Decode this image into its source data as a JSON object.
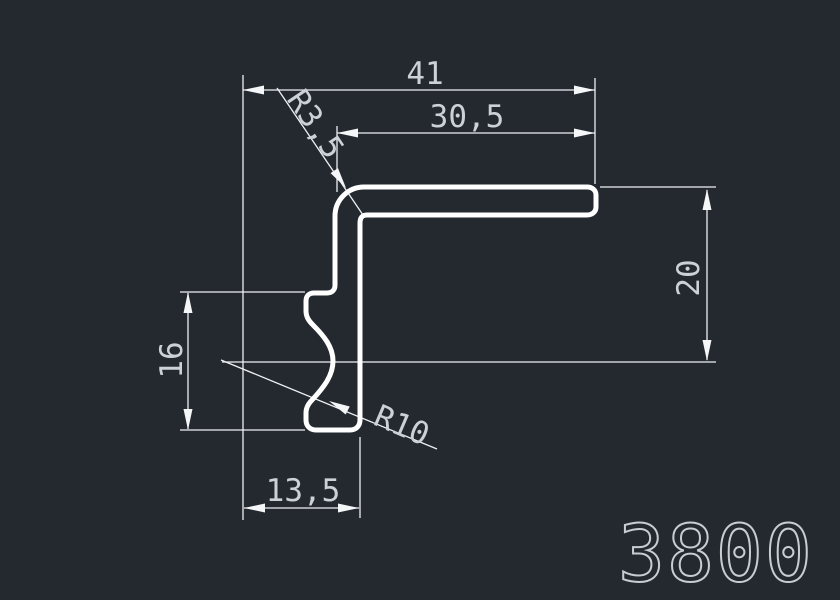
{
  "app": {
    "type": "cad-profile-drawing-viewer",
    "background_color": "#23292f",
    "profile_line_color": "#ffffff",
    "dimension_line_color": "#eef1f3",
    "dimension_text_color": "#ccd1d5",
    "part_number_color": "#c8cdd1"
  },
  "drawing": {
    "part_number": "3800",
    "description": "L-shaped aluminium profile cross-section with dimensions",
    "dimensions": {
      "overall_width": {
        "label": "41",
        "value": 41
      },
      "top_width": {
        "label": "30,5",
        "value": 30.5
      },
      "corner_radius": {
        "label": "R3,5",
        "value": 3.5
      },
      "right_height": {
        "label": "20",
        "value": 20
      },
      "left_height": {
        "label": "16",
        "value": 16
      },
      "bottom_width": {
        "label": "13,5",
        "value": 13.5
      },
      "groove_radius": {
        "label": "R10",
        "value": 10
      }
    }
  }
}
